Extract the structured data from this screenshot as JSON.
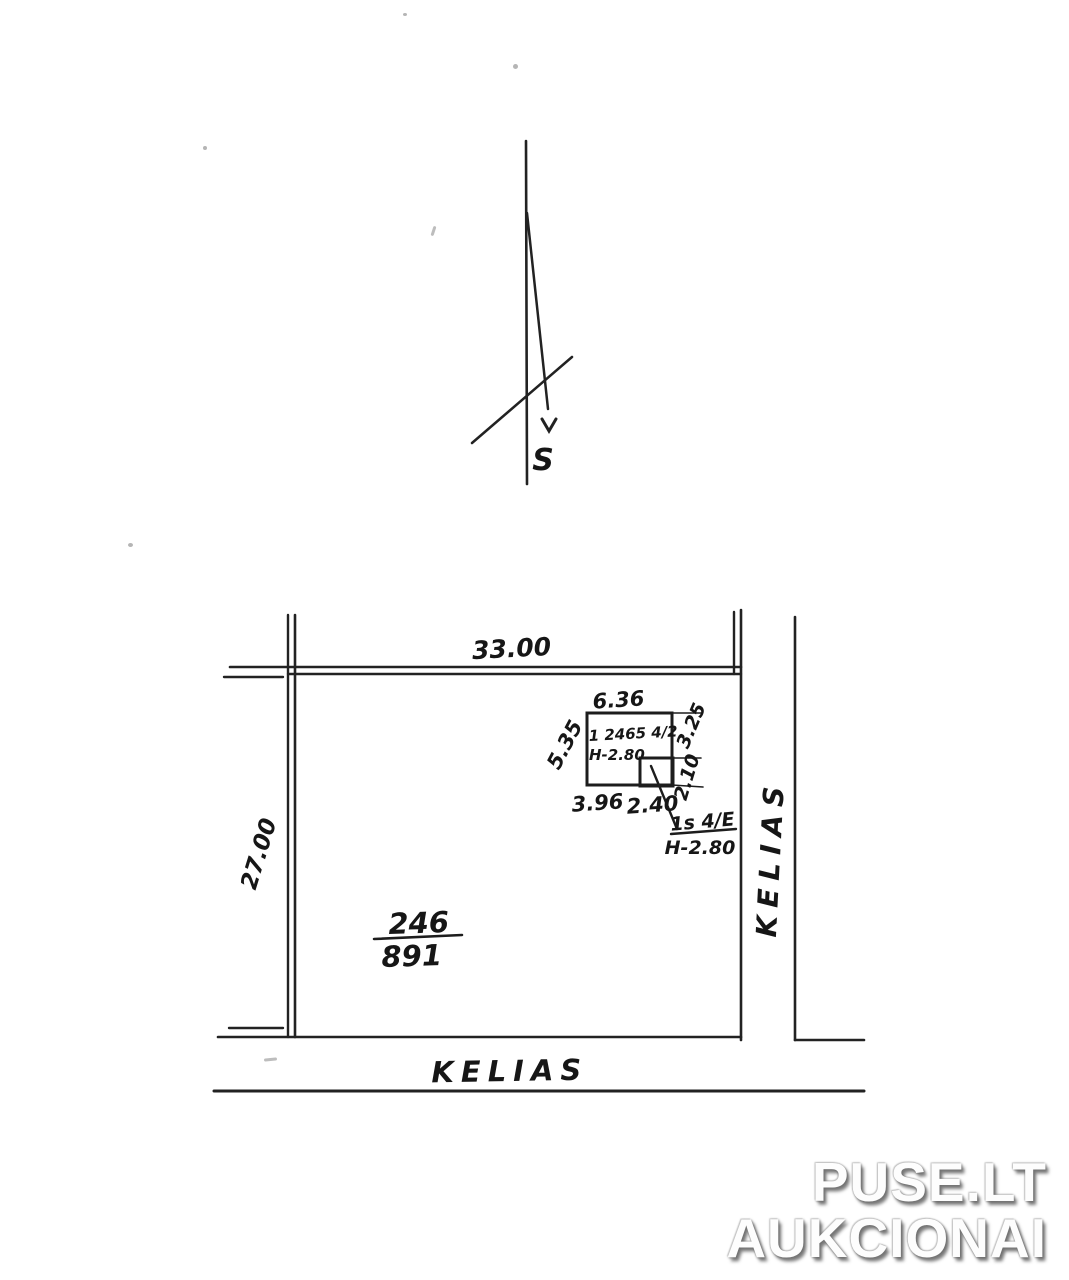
{
  "compass": {
    "south_label": "S"
  },
  "plot": {
    "top_dimension": "33.00",
    "left_dimension": "27.00",
    "parcel_number": "246",
    "parcel_area": "891",
    "road_label_right": "KELIAS",
    "road_label_bottom": "KELIAS"
  },
  "building": {
    "top_dimension": "6.36",
    "left_dimension": "5.35",
    "inventory_label": "1 2465 4/2",
    "height_label": "H-2.80",
    "right_top_dimension": "3.25",
    "right_bottom_dimension": "2.10",
    "bottom_left_dimension": "3.96",
    "bottom_right_dimension": "2.40"
  },
  "annex": {
    "label": "1s 4/E",
    "height_label": "H-2.80"
  },
  "watermark": {
    "line1": "PUSE.LT",
    "line2": "AUKCIONAI"
  },
  "colors": {
    "ink": "#1f1f1f",
    "background": "#ffffff"
  }
}
